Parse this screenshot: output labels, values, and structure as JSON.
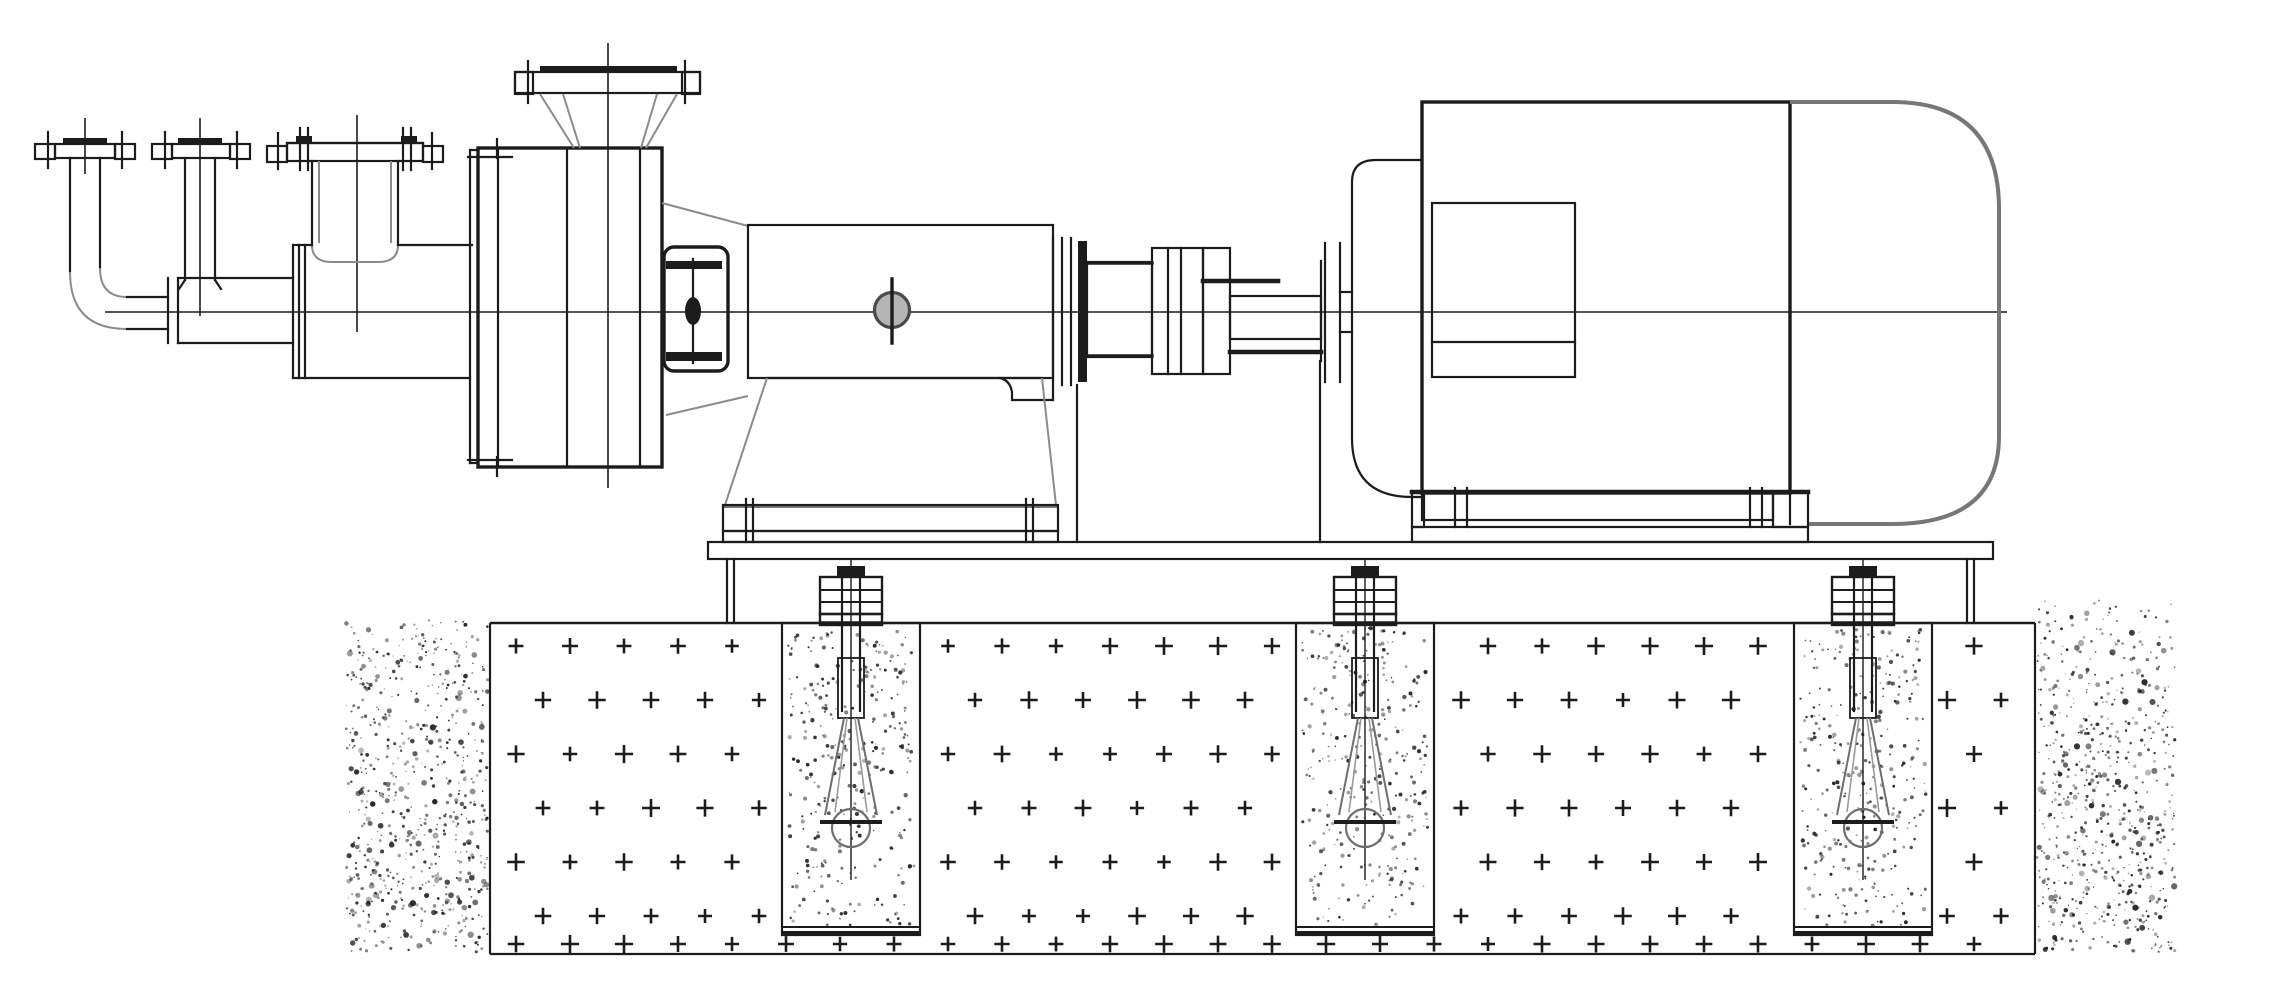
{
  "drawing": {
    "kind": "engineering-line-drawing",
    "subject": "horizontal centrifugal pump coupled to electric motor on a common baseplate, anchored with foundation bolts set in grout pockets of a concrete foundation",
    "view": "side elevation",
    "components": {
      "piping": [
        "drain-flange-small-1",
        "drain-flange-small-2",
        "suction-inlet-flange-large",
        "drain-elbow",
        "suction-spool",
        "pipe-joint-flanges",
        "suction-tee"
      ],
      "pump": [
        "discharge-flange",
        "discharge-neck",
        "pump-casing",
        "suction-cover",
        "casing-lug",
        "support-bracket"
      ],
      "drive_train": [
        "bearing-frame",
        "oil-sight-glass",
        "bearing-end-cover",
        "shaft-sleeve",
        "coupling-hub",
        "coupling-spacer",
        "coupling-guard",
        "motor-shaft-stub"
      ],
      "motor": [
        "motor-drive-end-bracket",
        "motor-body",
        "motor-stator-window",
        "motor-fan-cowl",
        "motor-feet"
      ],
      "mounting": [
        "pump-pedestal",
        "pedestal-rail",
        "motor-rail",
        "baseplate",
        "baseplate-skirts"
      ],
      "foundation": [
        "concrete-foundation-block",
        "grout-pockets",
        "anchor-bolts",
        "earth-fill"
      ]
    }
  },
  "palette": {
    "paper": "#ffffff",
    "ink": "#1c1c1c",
    "soft_gray": "#8b8b8b",
    "mid_gray": "#555555",
    "sight_glass_fill": "#b5b5b5",
    "sight_glass_rim": "#4a4a4a"
  },
  "centerlines": {
    "shaft_axis_y": 312,
    "pump_axis_x": 608
  },
  "foundation": {
    "seed": 1337,
    "block": {
      "left": 490,
      "right": 2035,
      "top": 623,
      "bottom": 954
    },
    "anchor_bolt_centers_x": [
      851,
      1365,
      1863
    ],
    "pocket": {
      "half_width": 69,
      "top": 623,
      "bottom": 935,
      "cap_line_y": 927
    },
    "concrete_hatch": {
      "rows": [
        646,
        700,
        754,
        808,
        862,
        916,
        944
      ],
      "col_start": 516,
      "col_step": 54,
      "stagger": 27,
      "arm": 8,
      "stroke_width": 2.6,
      "x_min": 502,
      "x_max": 2023,
      "pocket_margin": 82,
      "pocket_clear_below_y": 938
    },
    "earth_left": {
      "x": 346,
      "w": 142,
      "y": 620,
      "h": 332,
      "dots": 680
    },
    "earth_right": {
      "x": 2037,
      "w": 138,
      "y": 600,
      "h": 352,
      "dots": 680
    },
    "pocket_dots_each": 320
  }
}
